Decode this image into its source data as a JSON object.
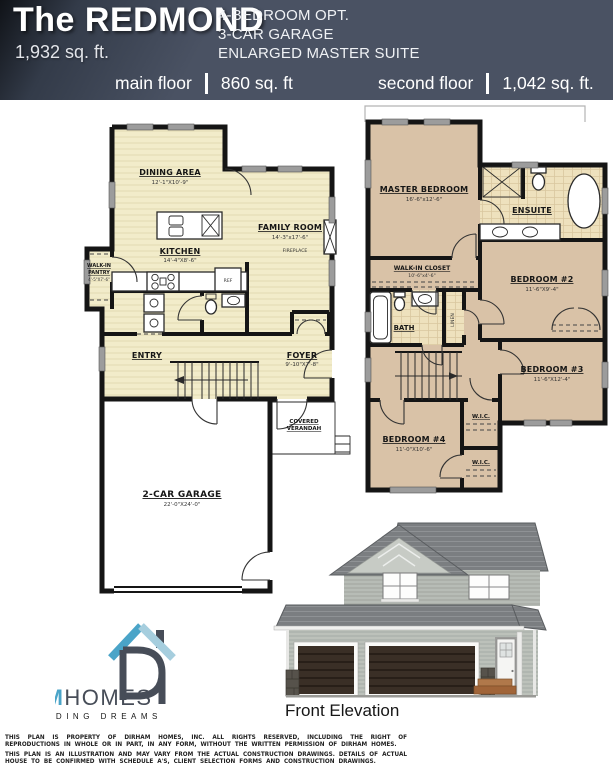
{
  "header": {
    "title": "The REDMOND",
    "total_area": "1,932 sq. ft.",
    "features": [
      "4-BEDROOM OPT.",
      "3-CAR GARAGE",
      "ENLARGED MASTER SUITE"
    ],
    "main_floor": {
      "label": "main floor",
      "area": "860 sq. ft"
    },
    "second_floor": {
      "label": "second floor",
      "area": "1,042 sq. ft."
    }
  },
  "main_floor_plan": {
    "dining": {
      "name": "DINING AREA",
      "dims": "12'-1\"X10'-9\""
    },
    "kitchen": {
      "name": "KITCHEN",
      "dims": "14'-4\"X8'-6\""
    },
    "family_room": {
      "name": "FAMILY ROOM",
      "dims": "14'-3\"x17'-6\""
    },
    "fireplace": "FIREPLACE",
    "pantry": {
      "line1": "WALK-IN",
      "line2": "PANTRY",
      "dims": "4'-5\"X7'-6\""
    },
    "entry": "ENTRY",
    "foyer": {
      "name": "FOYER",
      "dims": "9'-10\"X7'-8\""
    },
    "verandah": {
      "line1": "COVERED",
      "line2": "VERANDAH"
    },
    "garage": {
      "name": "2-CAR GARAGE",
      "dims": "22'-0\"X24'-0\""
    },
    "fridge": "REF"
  },
  "second_floor_plan": {
    "master": {
      "name": "MASTER BEDROOM",
      "dims": "16'-6\"x12'-6\""
    },
    "ensuite": "ENSUITE",
    "walk_in_closet": {
      "name": "WALK-IN CLOSET",
      "dims": "10'-6\"x4'-6\""
    },
    "bedroom2": {
      "name": "BEDROOM #2",
      "dims": "11'-6\"X9'-4\""
    },
    "bath": "BATH",
    "linen": "LINEN",
    "bedroom3": {
      "name": "BEDROOM #3",
      "dims": "11'-6\"X12'-4\""
    },
    "bedroom4": {
      "name": "BEDROOM #4",
      "dims": "11'-0\"X10'-6\""
    },
    "wic1": "W.I.C.",
    "wic2": "W.I.C."
  },
  "elevation": {
    "label": "Front Elevation"
  },
  "logo": {
    "brand_primary": "DIRHAM",
    "brand_secondary": "HOMES",
    "tagline": "BUILDING DREAMS"
  },
  "footer": {
    "line1": "THIS PLAN IS PROPERTY OF DIRHAM HOMES, INC. ALL RIGHTS RESERVED, INCLUDING THE RIGHT OF REPRODUCTIONS IN WHOLE OR IN PART, IN ANY FORM, WITHOUT THE WRITTEN PERMISSION OF DIRHAM HOMES.",
    "line2": "THIS PLAN IS AN ILLUSTRATION AND MAY VARY FROM THE ACTUAL CONSTRUCTION DRAWINGS. DETAILS OF ACTUAL HOUSE TO BE CONFIRMED WITH SCHEDULE A'S, CLIENT SELECTION FORMS AND CONSTRUCTION DRAWINGS."
  },
  "colors": {
    "header_bg": "#4a5263",
    "main_floor_fill": "#f2ecca",
    "second_floor_fill": "#d9c2a7",
    "tile_fill": "#eee1bd",
    "logo_blue": "#4aa4c8",
    "logo_dark": "#474d58"
  }
}
